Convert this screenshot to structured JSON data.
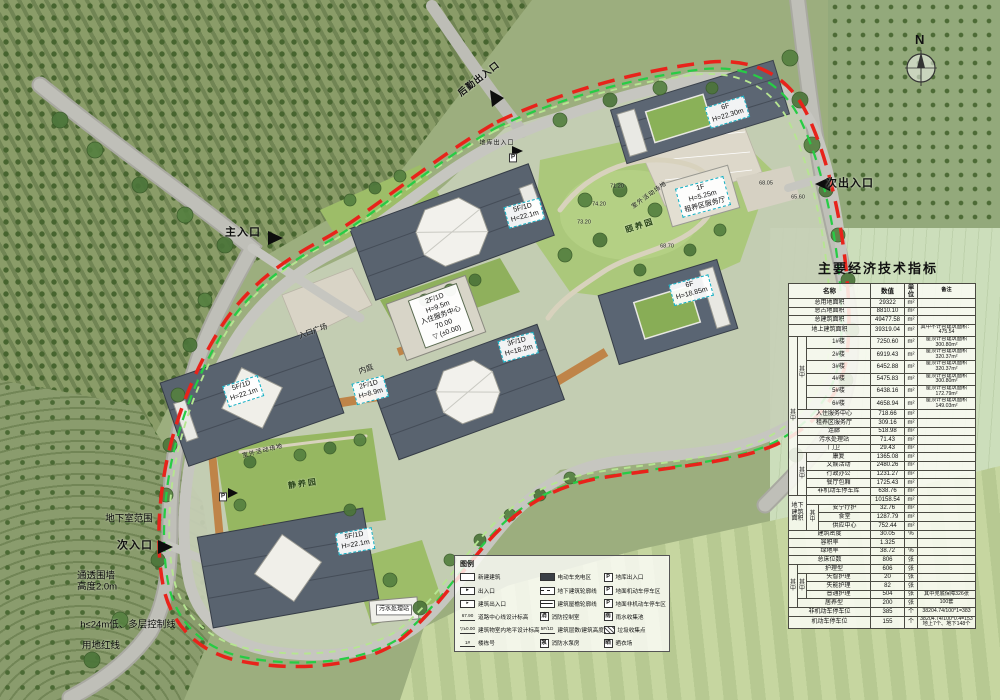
{
  "compass": {
    "label": "N"
  },
  "table": {
    "title": "主要经济技术指标",
    "rows": [
      [
        {
          "t": "名称",
          "cs": 4,
          "cls": "hd"
        },
        {
          "t": "数值",
          "cls": "hd"
        },
        {
          "t": "单位",
          "cls": "hd"
        },
        {
          "t": "备注",
          "cls": "hd"
        }
      ],
      [
        {
          "t": "总用地面积",
          "cs": 4,
          "cls": "nm"
        },
        {
          "t": "29322"
        },
        {
          "t": "m²"
        },
        {
          "t": ""
        }
      ],
      [
        {
          "t": "总占地面积",
          "cs": 4,
          "cls": "nm"
        },
        {
          "t": "8810.10"
        },
        {
          "t": "m²"
        },
        {
          "t": ""
        }
      ],
      [
        {
          "t": "总建筑面积",
          "cs": 4,
          "cls": "nm"
        },
        {
          "t": "49477.58"
        },
        {
          "t": "m²"
        },
        {
          "t": ""
        }
      ],
      [
        {
          "t": "地上建筑面积",
          "cs": 4,
          "cls": "nm"
        },
        {
          "t": "39319.04"
        },
        {
          "t": "m²"
        },
        {
          "t": "其中不计容建筑面积：475.54"
        }
      ],
      [
        {
          "t": "其中",
          "rs": 16,
          "cls": "grp"
        },
        {
          "t": "其中",
          "rs": 6,
          "cls": "grp"
        },
        {
          "t": "1#楼",
          "cs": 2
        },
        {
          "t": "7250.60"
        },
        {
          "t": "m²"
        },
        {
          "t": "屋顶计容建筑面积300.80m²"
        }
      ],
      [
        {
          "t": "2#楼",
          "cs": 2
        },
        {
          "t": "6919.43"
        },
        {
          "t": "m²"
        },
        {
          "t": "屋顶计容建筑面积320.37m²"
        }
      ],
      [
        {
          "t": "3#楼",
          "cs": 2
        },
        {
          "t": "6452.88"
        },
        {
          "t": "m²"
        },
        {
          "t": "屋顶计容建筑面积320.37m²"
        }
      ],
      [
        {
          "t": "4#楼",
          "cs": 2
        },
        {
          "t": "5475.83"
        },
        {
          "t": "m²"
        },
        {
          "t": "屋顶计容建筑面积300.80m²"
        }
      ],
      [
        {
          "t": "5#楼",
          "cs": 2
        },
        {
          "t": "6438.16"
        },
        {
          "t": "m²"
        },
        {
          "t": "屋顶计容建筑面积172.79m²"
        }
      ],
      [
        {
          "t": "6#楼",
          "cs": 2
        },
        {
          "t": "4658.94"
        },
        {
          "t": "m²"
        },
        {
          "t": "屋顶计容建筑面积149.03m²"
        }
      ],
      [
        {
          "t": "入住服务中心",
          "cs": 3
        },
        {
          "t": "718.66"
        },
        {
          "t": "m²"
        },
        {
          "t": ""
        }
      ],
      [
        {
          "t": "租养区服务厅",
          "cs": 3
        },
        {
          "t": "309.16"
        },
        {
          "t": "m²"
        },
        {
          "t": ""
        }
      ],
      [
        {
          "t": "连廊",
          "cs": 3
        },
        {
          "t": "518.98"
        },
        {
          "t": "m²"
        },
        {
          "t": ""
        }
      ],
      [
        {
          "t": "污水处理站",
          "cs": 3
        },
        {
          "t": "71.43"
        },
        {
          "t": "m²"
        },
        {
          "t": ""
        }
      ],
      [
        {
          "t": "门卫",
          "cs": 3
        },
        {
          "t": "29.43"
        },
        {
          "t": "m²"
        },
        {
          "t": ""
        }
      ],
      [
        {
          "t": "其中",
          "rs": 5,
          "cls": "grp"
        },
        {
          "t": "康复",
          "cs": 2
        },
        {
          "t": "1365.08"
        },
        {
          "t": "m²"
        },
        {
          "t": ""
        }
      ],
      [
        {
          "t": "文娱活动",
          "cs": 2
        },
        {
          "t": "2480.26"
        },
        {
          "t": "m²"
        },
        {
          "t": ""
        }
      ],
      [
        {
          "t": "行政办公",
          "cs": 2
        },
        {
          "t": "1231.27"
        },
        {
          "t": "m²"
        },
        {
          "t": ""
        }
      ],
      [
        {
          "t": "餐厅包厢",
          "cs": 2
        },
        {
          "t": "1725.43"
        },
        {
          "t": "m²"
        },
        {
          "t": ""
        }
      ],
      [
        {
          "t": "非机动车停车库",
          "cs": 2
        },
        {
          "t": "638.76"
        },
        {
          "t": "m²"
        },
        {
          "t": ""
        }
      ],
      [
        {
          "t": "地下建筑面积",
          "cs": 2,
          "rs": 4,
          "cls": "nm"
        },
        {
          "t": "",
          "cs": 2
        },
        {
          "t": "10158.54"
        },
        {
          "t": "m²"
        },
        {
          "t": ""
        }
      ],
      [
        {
          "t": "其中",
          "rs": 3,
          "cls": "grp"
        },
        {
          "t": "安宁疗护"
        },
        {
          "t": "32.76"
        },
        {
          "t": "m²"
        },
        {
          "t": ""
        }
      ],
      [
        {
          "t": "食堂"
        },
        {
          "t": "1287.79"
        },
        {
          "t": "m²"
        },
        {
          "t": ""
        }
      ],
      [
        {
          "t": "供应中心"
        },
        {
          "t": "752.44"
        },
        {
          "t": "m²"
        },
        {
          "t": ""
        }
      ],
      [
        {
          "t": "建筑密度",
          "cs": 4,
          "cls": "nm"
        },
        {
          "t": "30.05"
        },
        {
          "t": "%"
        },
        {
          "t": ""
        }
      ],
      [
        {
          "t": "容积率",
          "cs": 4,
          "cls": "nm"
        },
        {
          "t": "1.325"
        },
        {
          "t": ""
        },
        {
          "t": ""
        }
      ],
      [
        {
          "t": "绿地率",
          "cs": 4,
          "cls": "nm"
        },
        {
          "t": "38.72"
        },
        {
          "t": "%"
        },
        {
          "t": ""
        }
      ],
      [
        {
          "t": "总床位数",
          "cs": 4,
          "cls": "nm"
        },
        {
          "t": "806"
        },
        {
          "t": "张"
        },
        {
          "t": ""
        }
      ],
      [
        {
          "t": "其中",
          "rs": 5,
          "cls": "grp"
        },
        {
          "t": "护理型",
          "cs": 3
        },
        {
          "t": "606"
        },
        {
          "t": "张"
        },
        {
          "t": ""
        }
      ],
      [
        {
          "t": "其中",
          "rs": 3,
          "cls": "grp"
        },
        {
          "t": "失智护理",
          "cs": 2
        },
        {
          "t": "20"
        },
        {
          "t": "张"
        },
        {
          "t": ""
        }
      ],
      [
        {
          "t": "失能护理",
          "cs": 2
        },
        {
          "t": "82"
        },
        {
          "t": "张"
        },
        {
          "t": ""
        }
      ],
      [
        {
          "t": "普通护理",
          "cs": 2
        },
        {
          "t": "504"
        },
        {
          "t": "张"
        },
        {
          "t": "其中兜底保障326张"
        }
      ],
      [
        {
          "t": "居养型",
          "cs": 3
        },
        {
          "t": "200"
        },
        {
          "t": "张"
        },
        {
          "t": "100套"
        }
      ],
      [
        {
          "t": "非机动车停车位",
          "cs": 4,
          "cls": "nm"
        },
        {
          "t": "385"
        },
        {
          "t": "个"
        },
        {
          "t": "38204.74/100*1=383"
        }
      ],
      [
        {
          "t": "机动车停车位",
          "cs": 4,
          "cls": "nm"
        },
        {
          "t": "155"
        },
        {
          "t": "个"
        },
        {
          "t": "38204.74/100*0.4=153\n地上7个、地下148个"
        }
      ]
    ]
  },
  "legend": {
    "title": "图例",
    "columns": [
      [
        {
          "icon": "new-bldg",
          "glyph": "",
          "label": "新建建筑"
        },
        {
          "icon": "entrance-arrow",
          "glyph": "►",
          "label": "出入口"
        },
        {
          "icon": "bldg-entrance",
          "glyph": "▸",
          "label": "建筑出入口"
        },
        {
          "icon": "road-elev",
          "glyph": "67.90",
          "label": "道路中心线设计标高"
        },
        {
          "icon": "floor-elev",
          "glyph": "▽±0.00",
          "label": "建筑物室内地平设计标高"
        },
        {
          "icon": "bldg-no",
          "glyph": "1#",
          "label": "楼栋号"
        }
      ],
      [
        {
          "icon": "ev-charge",
          "glyph": "",
          "label": "电动车充电区"
        },
        {
          "icon": "dash-outline",
          "glyph": "",
          "label": "地下建筑轮廓线"
        },
        {
          "icon": "eave-line",
          "glyph": "",
          "label": "建筑屋檐轮廓线"
        },
        {
          "icon": "fire-ctrl",
          "glyph": "消",
          "label": "消防控制室"
        },
        {
          "icon": "floors-height",
          "glyph": "5F/1D",
          "label": "建筑层数/建筑高度"
        },
        {
          "icon": "fire-pump",
          "glyph": "泵",
          "label": "消防水泵房"
        }
      ],
      [
        {
          "icon": "p-garage",
          "glyph": "P",
          "label": "地库出入口"
        },
        {
          "icon": "p-car",
          "glyph": "P",
          "label": "地面机动车停车区"
        },
        {
          "icon": "p-bike",
          "glyph": "P",
          "label": "地面非机动车停车区"
        },
        {
          "icon": "rain",
          "glyph": "雨",
          "label": "雨水收集池"
        },
        {
          "icon": "trash",
          "glyph": "",
          "label": "垃圾收集点"
        },
        {
          "icon": "dry",
          "glyph": "晒",
          "label": "晒衣场"
        }
      ]
    ]
  },
  "plan": {
    "labels": [
      {
        "name": "houqin-exit",
        "text": "后勤出入口",
        "x": 479,
        "y": 79,
        "rot": -38,
        "cls": "med"
      },
      {
        "name": "diku-entrance",
        "text": "地库出入口",
        "x": 497,
        "y": 144,
        "rot": 0,
        "cls": "tiny"
      },
      {
        "name": "ci-exit",
        "text": "次出入口",
        "x": 850,
        "y": 184,
        "rot": 0,
        "cls": "big"
      },
      {
        "name": "zhu-entrance",
        "text": "主入口",
        "x": 243,
        "y": 233,
        "rot": 0,
        "cls": "big"
      },
      {
        "name": "entrance-plaza",
        "text": "入口广场",
        "x": 313,
        "y": 331,
        "rot": -20,
        "cls": "small"
      },
      {
        "name": "inner-court",
        "text": "内庭",
        "x": 366,
        "y": 369,
        "rot": -20,
        "cls": "small"
      },
      {
        "name": "outdoor-area-1",
        "text": "室外活动场地",
        "x": 650,
        "y": 196,
        "rot": -36,
        "cls": "tiny"
      },
      {
        "name": "outdoor-area-2",
        "text": "室外活动场地",
        "x": 263,
        "y": 452,
        "rot": -14,
        "cls": "tiny"
      },
      {
        "name": "yiyang-garden",
        "text": "颐养园",
        "x": 640,
        "y": 226,
        "rot": -18,
        "cls": "garden"
      },
      {
        "name": "jingyang-garden",
        "text": "静养园",
        "x": 303,
        "y": 484,
        "rot": -8,
        "cls": "garden"
      },
      {
        "name": "service-center-box",
        "text": "2F/1D\nH=9.5m\n入住服务中心\n70.00\n▽ (±0.00)",
        "x": 441,
        "y": 316,
        "rot": -20,
        "cls": "white-box"
      },
      {
        "name": "bldg-label-6f-2230",
        "text": "6F\nH=22.30m",
        "x": 727,
        "y": 112,
        "rot": -17,
        "cls": "bldg-box"
      },
      {
        "name": "bldg-label-1f-525",
        "text": "1F\nH=5.25m\n租养区服务厅",
        "x": 703,
        "y": 197,
        "rot": -15,
        "cls": "bldg-box"
      },
      {
        "name": "bldg-label-5f-north",
        "text": "5F/1D\nH=22.1m",
        "x": 524,
        "y": 213,
        "rot": -15,
        "cls": "bldg-box"
      },
      {
        "name": "bldg-label-6f-1885",
        "text": "6F\nH=18.85m",
        "x": 691,
        "y": 290,
        "rot": -15,
        "cls": "bldg-box"
      },
      {
        "name": "bldg-label-3f-182",
        "text": "3F/1D\nH=18.2m",
        "x": 518,
        "y": 347,
        "rot": -15,
        "cls": "bldg-box"
      },
      {
        "name": "bldg-label-5f-west",
        "text": "5F/1D\nH=22.1m",
        "x": 243,
        "y": 391,
        "rot": -18,
        "cls": "bldg-box"
      },
      {
        "name": "bldg-label-2f-89",
        "text": "2F/1D\nH=8.9m",
        "x": 370,
        "y": 390,
        "rot": -15,
        "cls": "bldg-box"
      },
      {
        "name": "bldg-label-5f-south",
        "text": "5F/1D\nH=22.1m",
        "x": 355,
        "y": 541,
        "rot": -10,
        "cls": "bldg-box"
      },
      {
        "name": "sewage-station",
        "text": "污水处理站",
        "x": 394,
        "y": 610,
        "rot": 0,
        "cls": "station-box"
      },
      {
        "name": "basement-extent",
        "text": "地下室范围",
        "x": 129,
        "y": 519,
        "rot": 0,
        "cls": "note"
      },
      {
        "name": "ci-entrance",
        "text": "次入口",
        "x": 135,
        "y": 546,
        "rot": 0,
        "cls": "big"
      },
      {
        "name": "fence-note",
        "text": "通透围墙\n高度2.0m",
        "x": 97,
        "y": 582,
        "rot": 0,
        "cls": "note left"
      },
      {
        "name": "height-control-line",
        "text": "h≤24m低、多层控制线",
        "x": 128,
        "y": 625,
        "rot": 0,
        "cls": "note"
      },
      {
        "name": "red-line-note",
        "text": "用地红线",
        "x": 101,
        "y": 646,
        "rot": 0,
        "cls": "note"
      },
      {
        "name": "spot-elev-7120",
        "text": "71.20",
        "x": 617,
        "y": 187,
        "rot": 0,
        "cls": "spot"
      },
      {
        "name": "spot-elev-7420",
        "text": "74.20",
        "x": 599,
        "y": 205,
        "rot": 0,
        "cls": "spot"
      },
      {
        "name": "spot-elev-7320",
        "text": "73.20",
        "x": 584,
        "y": 223,
        "rot": 0,
        "cls": "spot"
      },
      {
        "name": "spot-elev-6870",
        "text": "68.70",
        "x": 667,
        "y": 247,
        "rot": 0,
        "cls": "spot"
      },
      {
        "name": "spot-elev-6805",
        "text": "68.05",
        "x": 766,
        "y": 184,
        "rot": 0,
        "cls": "spot"
      },
      {
        "name": "spot-elev-6560",
        "text": "65.60",
        "x": 798,
        "y": 198,
        "rot": 0,
        "cls": "spot"
      },
      {
        "name": "p-marker-1",
        "text": "P",
        "x": 223,
        "y": 497,
        "rot": 0,
        "cls": "p-marker"
      },
      {
        "name": "p-marker-2",
        "text": "P",
        "x": 513,
        "y": 158,
        "rot": 0,
        "cls": "p-marker"
      }
    ]
  }
}
